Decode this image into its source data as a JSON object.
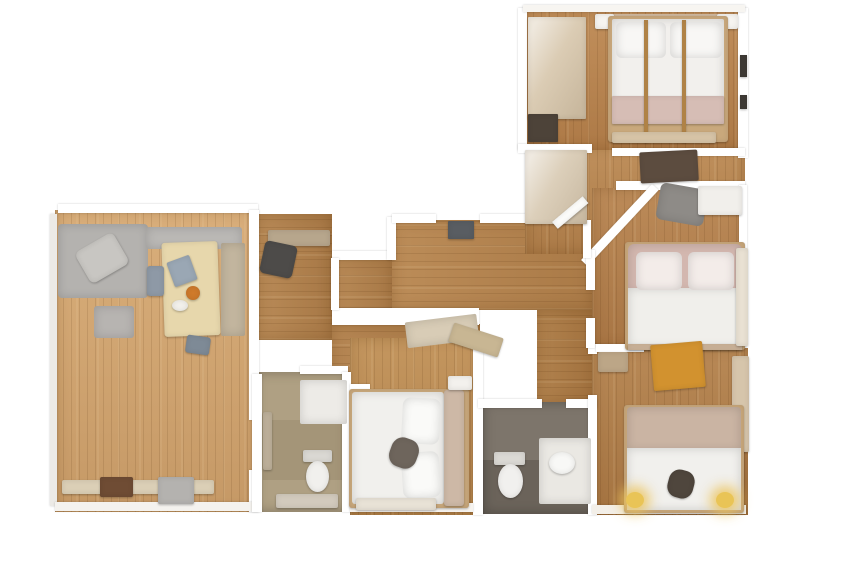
{
  "canvas": {
    "width": 848,
    "height": 565,
    "background": "#ffffff"
  },
  "palette": {
    "wood_living": "#d5a771",
    "wood_hall": "#b5834e",
    "wood_bedroom": "#b5814c",
    "tile_gray": "#7d756b",
    "tile_beige": "#afa083",
    "wall": "#ffffff",
    "duvet_white": "#f1f0ed",
    "headboard_pink": "#d3b7af",
    "headboard_tan": "#cab4a3",
    "sofa_gray": "#b4b2af",
    "table_lightwood": "#e7d7ac",
    "desk_orange": "#d2922f",
    "lamp_yellow": "#e9c456"
  },
  "shapes": [
    {
      "n": "living-room-floor",
      "x": 55,
      "y": 210,
      "w": 203,
      "h": 302,
      "f": "#d5a771",
      "c": "floor plank-v"
    },
    {
      "n": "hall-nook-floor",
      "x": 258,
      "y": 214,
      "w": 74,
      "h": 126,
      "f": "#b3824d",
      "c": "floor plank-h"
    },
    {
      "n": "hall-mid-floor",
      "x": 332,
      "y": 256,
      "w": 62,
      "h": 84,
      "f": "#b3824d",
      "c": "floor plank-h"
    },
    {
      "n": "hall-main-floor",
      "x": 392,
      "y": 220,
      "w": 200,
      "h": 90,
      "f": "#b6844e",
      "c": "floor plank-h"
    },
    {
      "n": "hall-lower-corridor-floor",
      "x": 332,
      "y": 324,
      "w": 148,
      "h": 64,
      "f": "#b07e49",
      "c": "floor plank-h"
    },
    {
      "n": "hall-bath-corridor-floor",
      "x": 537,
      "y": 310,
      "w": 60,
      "h": 94,
      "f": "#ab7943",
      "c": "floor plank-h"
    },
    {
      "n": "entry-wing-floor",
      "x": 525,
      "y": 146,
      "w": 220,
      "h": 108,
      "f": "#b8854f",
      "c": "floor plank-v"
    },
    {
      "n": "bedroom-top-floor",
      "x": 525,
      "y": 10,
      "w": 220,
      "h": 140,
      "f": "#ba844e",
      "c": "floor plank-v"
    },
    {
      "n": "bedroom-middle-floor",
      "x": 592,
      "y": 188,
      "w": 153,
      "h": 160,
      "f": "#b47f4b",
      "c": "floor plank-v"
    },
    {
      "n": "bedroom-bottomright-floor",
      "x": 592,
      "y": 348,
      "w": 156,
      "h": 167,
      "f": "#b07d48",
      "c": "floor plank-v"
    },
    {
      "n": "bedroom-center-floor",
      "x": 350,
      "y": 338,
      "w": 132,
      "h": 177,
      "f": "#bd8c52",
      "c": "floor plank-v"
    },
    {
      "n": "bathroom-beige-floor",
      "x": 255,
      "y": 372,
      "w": 93,
      "h": 140,
      "f": "#afa083",
      "c": "tile"
    },
    {
      "n": "bathroom-gray-floor",
      "x": 483,
      "y": 402,
      "w": 114,
      "h": 112,
      "f": "#7d756b",
      "c": "tile"
    },
    {
      "n": "bathroom-gray-shading",
      "x": 483,
      "y": 460,
      "w": 114,
      "h": 54,
      "f": "rgba(35,30,25,0.20)",
      "c": "ov"
    },
    {
      "n": "bathroom-beige-shading",
      "x": 263,
      "y": 420,
      "w": 80,
      "h": 60,
      "f": "rgba(90,75,45,0.12)",
      "c": "ov"
    },
    {
      "n": "wall-living-top",
      "x": 58,
      "y": 204,
      "w": 200,
      "h": 9,
      "c": "wall"
    },
    {
      "n": "wall-living-right-upper",
      "x": 249,
      "y": 210,
      "w": 10,
      "h": 210,
      "c": "wall"
    },
    {
      "n": "wall-living-right-lower",
      "x": 249,
      "y": 470,
      "w": 10,
      "h": 42,
      "c": "wall"
    },
    {
      "n": "wall-living-left",
      "x": 50,
      "y": 214,
      "w": 7,
      "h": 292,
      "f": "#eceae6",
      "c": "wall"
    },
    {
      "n": "wall-living-bottom",
      "x": 55,
      "y": 502,
      "w": 203,
      "h": 9,
      "f": "#f4f2ee",
      "c": "wall"
    },
    {
      "n": "wall-hall-top-left",
      "x": 332,
      "y": 251,
      "w": 62,
      "h": 9,
      "c": "wall"
    },
    {
      "n": "wall-hall-step",
      "x": 387,
      "y": 217,
      "w": 9,
      "h": 43,
      "c": "wall"
    },
    {
      "n": "wall-hall-top-a",
      "x": 392,
      "y": 214,
      "w": 44,
      "h": 9,
      "c": "wall"
    },
    {
      "n": "wall-hall-top-b",
      "x": 480,
      "y": 214,
      "w": 46,
      "h": 9,
      "c": "wall"
    },
    {
      "n": "wall-hall-band",
      "x": 332,
      "y": 308,
      "w": 147,
      "h": 17,
      "c": "wall"
    },
    {
      "n": "wall-hall-left-seg",
      "x": 331,
      "y": 258,
      "w": 8,
      "h": 52,
      "c": "wall"
    },
    {
      "n": "wall-center-bedroom-right",
      "x": 473,
      "y": 338,
      "w": 10,
      "h": 177,
      "c": "wall"
    },
    {
      "n": "wall-bathgray-top-a",
      "x": 478,
      "y": 399,
      "w": 64,
      "h": 9,
      "c": "wall"
    },
    {
      "n": "wall-bathgray-top-b",
      "x": 566,
      "y": 399,
      "w": 31,
      "h": 9,
      "c": "wall"
    },
    {
      "n": "wall-bedroom-br-left-upper",
      "x": 588,
      "y": 344,
      "w": 9,
      "h": 10,
      "c": "wall"
    },
    {
      "n": "wall-bedroom-br-left",
      "x": 588,
      "y": 395,
      "w": 9,
      "h": 120,
      "c": "wall"
    },
    {
      "n": "wall-bedtop-left",
      "x": 518,
      "y": 8,
      "w": 9,
      "h": 142,
      "c": "wall"
    },
    {
      "n": "wall-bedtop-right",
      "x": 738,
      "y": 8,
      "w": 10,
      "h": 150,
      "c": "wall"
    },
    {
      "n": "wall-bedtop-top",
      "x": 523,
      "y": 5,
      "w": 222,
      "h": 7,
      "f": "#f7f5f1",
      "c": "wall"
    },
    {
      "n": "wall-bedtop-bottom-a",
      "x": 518,
      "y": 144,
      "w": 74,
      "h": 9,
      "c": "wall"
    },
    {
      "n": "wall-bedtop-bottom-b",
      "x": 612,
      "y": 148,
      "w": 133,
      "h": 8,
      "c": "wall"
    },
    {
      "n": "wall-bedmid-top",
      "x": 616,
      "y": 181,
      "w": 129,
      "h": 9,
      "c": "wall"
    },
    {
      "n": "wall-entry-diagonal",
      "x": 652,
      "y": 184,
      "w": 9,
      "h": 104,
      "rot": 43,
      "o": "top left",
      "c": "wall"
    },
    {
      "n": "wall-bedmid-left-a",
      "x": 586,
      "y": 250,
      "w": 9,
      "h": 40,
      "c": "wall"
    },
    {
      "n": "wall-bedmid-left-b",
      "x": 586,
      "y": 318,
      "w": 9,
      "h": 30,
      "c": "wall"
    },
    {
      "n": "wall-bedmid-right",
      "x": 739,
      "y": 185,
      "w": 8,
      "h": 66,
      "c": "wall"
    },
    {
      "n": "wall-hall-entry-vertical",
      "x": 583,
      "y": 220,
      "w": 8,
      "h": 38,
      "c": "wall"
    },
    {
      "n": "wall-bedroom-br-top-a",
      "x": 596,
      "y": 344,
      "w": 48,
      "h": 8,
      "c": "wall"
    },
    {
      "n": "wall-bedroom-br-top-b",
      "x": 652,
      "y": 344,
      "w": 30,
      "h": 8,
      "c": "wall"
    },
    {
      "n": "wall-bedroom-br-bottom",
      "x": 592,
      "y": 505,
      "w": 154,
      "h": 9,
      "f": "#f3efe8",
      "c": "wall"
    },
    {
      "n": "wall-bathbeige-left",
      "x": 252,
      "y": 374,
      "w": 10,
      "h": 138,
      "c": "wall"
    },
    {
      "n": "wall-bathbeige-top",
      "x": 300,
      "y": 366,
      "w": 48,
      "h": 8,
      "c": "wall"
    },
    {
      "n": "wall-bathbeige-right",
      "x": 342,
      "y": 372,
      "w": 9,
      "h": 140,
      "c": "wall"
    },
    {
      "n": "wall-center-bedroom-top-seg",
      "x": 350,
      "y": 384,
      "w": 20,
      "h": 8,
      "c": "wall"
    },
    {
      "n": "wall-center-bedroom-bottom",
      "x": 350,
      "y": 503,
      "w": 123,
      "h": 9,
      "f": "#f6f3ee",
      "c": "wall"
    },
    {
      "n": "sofa",
      "x": 58,
      "y": 224,
      "w": 90,
      "h": 74,
      "f": "#b4b2af",
      "r": "4px",
      "c": "furn soft"
    },
    {
      "n": "sofa-blanket",
      "x": 80,
      "y": 240,
      "w": 44,
      "h": 36,
      "f": "#c8c6c2",
      "r": "6px",
      "rot": -30,
      "c": "furn"
    },
    {
      "n": "sofa-back-cushions",
      "x": 146,
      "y": 227,
      "w": 96,
      "h": 22,
      "f": "#bab8b5",
      "r": "3px",
      "c": "furn soft"
    },
    {
      "n": "ottoman",
      "x": 94,
      "y": 306,
      "w": 40,
      "h": 32,
      "f": "#b7b4b1",
      "r": "3px",
      "c": "furn soft"
    },
    {
      "n": "dining-table",
      "x": 163,
      "y": 242,
      "w": 56,
      "h": 94,
      "f": "#e7d7ac",
      "r": "3px",
      "rot": -2,
      "c": "furn"
    },
    {
      "n": "laptop-on-table",
      "x": 170,
      "y": 258,
      "w": 24,
      "h": 26,
      "f": "#9aa7b4",
      "r": "2px",
      "rot": -20,
      "c": "furn"
    },
    {
      "n": "bowl-on-table",
      "x": 186,
      "y": 286,
      "w": 14,
      "h": 14,
      "f": "#cf7a2b",
      "r": "50%",
      "c": "furn"
    },
    {
      "n": "plate-on-table",
      "x": 172,
      "y": 300,
      "w": 16,
      "h": 11,
      "f": "#f3f1ec",
      "r": "50%",
      "c": "furn"
    },
    {
      "n": "dining-chair-left",
      "x": 147,
      "y": 266,
      "w": 17,
      "h": 30,
      "f": "#8e99a6",
      "r": "3px",
      "c": "furn"
    },
    {
      "n": "dining-chair-bottom",
      "x": 186,
      "y": 336,
      "w": 24,
      "h": 18,
      "f": "#7e8a96",
      "r": "3px",
      "rot": 8,
      "c": "furn"
    },
    {
      "n": "bench-sideboard",
      "x": 221,
      "y": 243,
      "w": 24,
      "h": 93,
      "f": "#c2b59e",
      "r": "2px",
      "c": "furn soft"
    },
    {
      "n": "desk-clutter-shelf",
      "x": 268,
      "y": 230,
      "w": 62,
      "h": 16,
      "f": "#b7a68c",
      "r": "2px",
      "c": "furn"
    },
    {
      "n": "office-chair",
      "x": 262,
      "y": 243,
      "w": 33,
      "h": 33,
      "f": "#4d4b49",
      "r": "5px",
      "rot": 12,
      "c": "furn"
    },
    {
      "n": "radiator-bench",
      "x": 62,
      "y": 480,
      "w": 152,
      "h": 14,
      "f": "#dbcfb6",
      "r": "2px",
      "c": "furn"
    },
    {
      "n": "dark-mat",
      "x": 100,
      "y": 477,
      "w": 33,
      "h": 20,
      "f": "#6f4c34",
      "r": "2px",
      "c": "furn"
    },
    {
      "n": "gray-storage-box",
      "x": 158,
      "y": 477,
      "w": 36,
      "h": 27,
      "f": "#b4b2af",
      "r": "2px",
      "c": "furn"
    },
    {
      "n": "entry-doormat",
      "x": 448,
      "y": 221,
      "w": 26,
      "h": 18,
      "f": "#595d62",
      "r": "1px",
      "c": "furn"
    },
    {
      "n": "hall-shoe-rack-a",
      "x": 406,
      "y": 318,
      "w": 72,
      "h": 26,
      "f": "#d8ccb6",
      "r": "2px",
      "rot": -7,
      "c": "furn soft"
    },
    {
      "n": "hall-shoe-rack-b",
      "x": 450,
      "y": 330,
      "w": 52,
      "h": 20,
      "f": "#c8b693",
      "r": "2px",
      "rot": 18,
      "c": "furn"
    },
    {
      "n": "entry-closet",
      "x": 525,
      "y": 150,
      "w": 62,
      "h": 74,
      "f": "#dccfba",
      "r": "1px",
      "c": "furn sheen"
    },
    {
      "n": "entry-closet-mirror-face",
      "x": 552,
      "y": 222,
      "w": 40,
      "h": 9,
      "f": "#fdfdfb",
      "rot": -40,
      "o": "top left",
      "c": "furn"
    },
    {
      "n": "entry-desk-dark",
      "x": 640,
      "y": 151,
      "w": 58,
      "h": 31,
      "f": "#5c4c3f",
      "r": "2px",
      "rot": -3,
      "c": "furn"
    },
    {
      "n": "entry-chair-gray",
      "x": 658,
      "y": 186,
      "w": 48,
      "h": 37,
      "f": "#8e8b87",
      "r": "6px",
      "rot": 10,
      "c": "furn soft"
    },
    {
      "n": "entry-desk-white",
      "x": 698,
      "y": 186,
      "w": 44,
      "h": 29,
      "f": "#f1efeb",
      "r": "2px",
      "c": "furn"
    },
    {
      "n": "bedroom-top-wardrobe",
      "x": 528,
      "y": 17,
      "w": 58,
      "h": 102,
      "f": "#dbccb4",
      "r": "1px",
      "c": "furn sheen"
    },
    {
      "n": "bedroom-top-dark-box",
      "x": 528,
      "y": 114,
      "w": 30,
      "h": 28,
      "f": "#4d4339",
      "r": "1px",
      "c": "furn"
    },
    {
      "n": "bedroom-top-nightstand-left",
      "x": 595,
      "y": 14,
      "w": 19,
      "h": 15,
      "f": "#f6f4f0",
      "r": "2px",
      "c": "furn"
    },
    {
      "n": "bedroom-top-nightstand-right",
      "x": 717,
      "y": 14,
      "w": 21,
      "h": 15,
      "f": "#f6f4f0",
      "r": "2px",
      "c": "furn"
    },
    {
      "n": "bedroom-top-headwall",
      "x": 596,
      "y": 14,
      "w": 142,
      "h": 10,
      "f": "#cbb49a",
      "c": "ov"
    },
    {
      "n": "bedroom-top-bed-frame",
      "x": 608,
      "y": 16,
      "w": 120,
      "h": 126,
      "f": "#c9a87c",
      "r": "3px",
      "c": "furn"
    },
    {
      "n": "bedroom-top-bed-mattress",
      "x": 612,
      "y": 19,
      "w": 112,
      "h": 102,
      "f": "#f2f0ed",
      "r": "2px",
      "c": "furn soft"
    },
    {
      "n": "bedroom-top-bed-foot-band",
      "x": 612,
      "y": 96,
      "w": 112,
      "h": 28,
      "f": "#d6bdb5",
      "r": "1px",
      "c": "furn"
    },
    {
      "n": "bedroom-top-pillow-left",
      "x": 616,
      "y": 22,
      "w": 50,
      "h": 36,
      "f": "#f8f7f5",
      "r": "6px",
      "c": "furn soft"
    },
    {
      "n": "bedroom-top-pillow-right",
      "x": 670,
      "y": 22,
      "w": 52,
      "h": 36,
      "f": "#f8f7f5",
      "r": "6px",
      "c": "furn soft"
    },
    {
      "n": "bedroom-top-bedpost-left",
      "x": 644,
      "y": 20,
      "w": 4,
      "h": 122,
      "f": "#b9894a",
      "c": "furn"
    },
    {
      "n": "bedroom-top-bedpost-right",
      "x": 682,
      "y": 20,
      "w": 4,
      "h": 122,
      "f": "#b9894a",
      "c": "furn"
    },
    {
      "n": "bedroom-top-bench",
      "x": 612,
      "y": 132,
      "w": 104,
      "h": 11,
      "f": "#d7c4a7",
      "r": "2px",
      "c": "furn"
    },
    {
      "n": "bedroom-top-wall-flecks-a",
      "x": 740,
      "y": 55,
      "w": 7,
      "h": 22,
      "f": "#3f3b36",
      "c": "furn"
    },
    {
      "n": "bedroom-top-wall-flecks-b",
      "x": 740,
      "y": 95,
      "w": 7,
      "h": 14,
      "f": "#3f3b36",
      "c": "furn"
    },
    {
      "n": "bedroom-mid-bed-frame",
      "x": 625,
      "y": 242,
      "w": 120,
      "h": 108,
      "f": "#c8a77b",
      "r": "3px",
      "c": "furn"
    },
    {
      "n": "bedroom-mid-headboard",
      "x": 628,
      "y": 244,
      "w": 114,
      "h": 48,
      "f": "#d3b7af",
      "r": "6px 6px 0 0",
      "c": "furn soft"
    },
    {
      "n": "bedroom-mid-duvet",
      "x": 628,
      "y": 288,
      "w": 114,
      "h": 60,
      "f": "#f0efeb",
      "c": "furn soft"
    },
    {
      "n": "bedroom-mid-pillow-left",
      "x": 636,
      "y": 252,
      "w": 46,
      "h": 38,
      "f": "#f3ece9",
      "r": "6px",
      "c": "furn soft"
    },
    {
      "n": "bedroom-mid-pillow-right",
      "x": 688,
      "y": 252,
      "w": 46,
      "h": 38,
      "f": "#f3ece9",
      "r": "6px",
      "c": "furn soft"
    },
    {
      "n": "bedroom-mid-foot-rail",
      "x": 628,
      "y": 344,
      "w": 114,
      "h": 6,
      "f": "#cdb49a",
      "c": "furn"
    },
    {
      "n": "bedroom-mid-curtain",
      "x": 736,
      "y": 248,
      "w": 12,
      "h": 98,
      "f": "#e9e1d3",
      "r": "2px",
      "c": "furn"
    },
    {
      "n": "bedroom-br-desk-orange",
      "x": 652,
      "y": 343,
      "w": 52,
      "h": 46,
      "f": "#d2922f",
      "r": "2px",
      "rot": -5,
      "c": "furn"
    },
    {
      "n": "bedroom-br-clutter",
      "x": 598,
      "y": 352,
      "w": 30,
      "h": 20,
      "f": "#bca687",
      "r": "2px",
      "c": "furn"
    },
    {
      "n": "bedroom-br-wardrobe",
      "x": 732,
      "y": 356,
      "w": 17,
      "h": 96,
      "f": "#d6c5ab",
      "r": "2px",
      "c": "furn"
    },
    {
      "n": "bedroom-br-bed-frame",
      "x": 624,
      "y": 405,
      "w": 120,
      "h": 108,
      "f": "#c8a77b",
      "r": "3px",
      "c": "furn"
    },
    {
      "n": "bedroom-br-headboard",
      "x": 627,
      "y": 407,
      "w": 114,
      "h": 44,
      "f": "#cab4a3",
      "r": "4px 4px 0 0",
      "c": "furn soft"
    },
    {
      "n": "bedroom-br-duvet",
      "x": 627,
      "y": 448,
      "w": 114,
      "h": 62,
      "f": "#f1f0ed",
      "c": "furn soft"
    },
    {
      "n": "bedroom-br-dark-item",
      "x": 668,
      "y": 470,
      "w": 26,
      "h": 28,
      "f": "#4f463d",
      "r": "40%",
      "rot": 15,
      "c": "furn"
    },
    {
      "n": "bedroom-br-lamp-left",
      "x": 626,
      "y": 492,
      "w": 18,
      "h": 16,
      "f": "#e9c456",
      "r": "50%",
      "c": "furn glow"
    },
    {
      "n": "bedroom-br-lamp-right",
      "x": 716,
      "y": 492,
      "w": 18,
      "h": 16,
      "f": "#e9c456",
      "r": "50%",
      "c": "furn glow"
    },
    {
      "n": "bedroom-center-bed-frame",
      "x": 349,
      "y": 389,
      "w": 120,
      "h": 119,
      "f": "#c8a77b",
      "r": "3px",
      "c": "furn"
    },
    {
      "n": "bedroom-center-mattress",
      "x": 352,
      "y": 392,
      "w": 92,
      "h": 112,
      "f": "#f1f0ed",
      "r": "3px",
      "c": "furn soft"
    },
    {
      "n": "bedroom-center-headboard",
      "x": 444,
      "y": 390,
      "w": 20,
      "h": 116,
      "f": "#cdb8a6",
      "r": "3px",
      "c": "furn"
    },
    {
      "n": "bedroom-center-pillow-top",
      "x": 402,
      "y": 398,
      "w": 38,
      "h": 46,
      "f": "#fafaf8",
      "r": "8px",
      "rot": 3,
      "c": "furn soft"
    },
    {
      "n": "bedroom-center-pillow-bottom",
      "x": 402,
      "y": 452,
      "w": 38,
      "h": 46,
      "f": "#fafaf8",
      "r": "8px",
      "rot": -4,
      "c": "furn soft"
    },
    {
      "n": "bedroom-center-dark-item",
      "x": 390,
      "y": 438,
      "w": 28,
      "h": 30,
      "f": "#6e655c",
      "r": "40%",
      "rot": 20,
      "c": "furn"
    },
    {
      "n": "bedroom-center-nightstand",
      "x": 448,
      "y": 376,
      "w": 24,
      "h": 14,
      "f": "#f3f1ed",
      "r": "2px",
      "c": "furn"
    },
    {
      "n": "bedroom-center-bench",
      "x": 356,
      "y": 498,
      "w": 80,
      "h": 12,
      "f": "#e8e2d6",
      "r": "2px",
      "c": "furn"
    },
    {
      "n": "bathroom-beige-shower",
      "x": 300,
      "y": 380,
      "w": 47,
      "h": 44,
      "f": "#edebe7",
      "r": "2px",
      "c": "furn soft"
    },
    {
      "n": "bathroom-beige-toilet-tank",
      "x": 303,
      "y": 450,
      "w": 29,
      "h": 12,
      "f": "#dad8d3",
      "r": "2px",
      "c": "furn"
    },
    {
      "n": "bathroom-beige-toilet-bowl",
      "x": 306,
      "y": 461,
      "w": 23,
      "h": 31,
      "f": "#f1f0ed",
      "r": "50%",
      "c": "furn"
    },
    {
      "n": "bathroom-beige-towel-rail",
      "x": 263,
      "y": 412,
      "w": 9,
      "h": 58,
      "f": "#bdb09a",
      "r": "2px",
      "c": "furn"
    },
    {
      "n": "bathroom-beige-vanity",
      "x": 276,
      "y": 494,
      "w": 62,
      "h": 14,
      "f": "#d2cabd",
      "r": "2px",
      "c": "furn"
    },
    {
      "n": "bathroom-gray-toilet-tank",
      "x": 494,
      "y": 452,
      "w": 31,
      "h": 13,
      "f": "#dbd9d4",
      "r": "2px",
      "c": "furn"
    },
    {
      "n": "bathroom-gray-toilet-bowl",
      "x": 498,
      "y": 464,
      "w": 25,
      "h": 34,
      "f": "#f1f0ee",
      "r": "50%",
      "c": "furn"
    },
    {
      "n": "bathroom-gray-vanity",
      "x": 539,
      "y": 438,
      "w": 52,
      "h": 66,
      "f": "#eae8e3",
      "r": "2px",
      "c": "furn soft"
    },
    {
      "n": "bathroom-gray-sink",
      "x": 549,
      "y": 452,
      "w": 26,
      "h": 22,
      "f": "#f8f8f6",
      "r": "50%",
      "c": "furn"
    }
  ]
}
